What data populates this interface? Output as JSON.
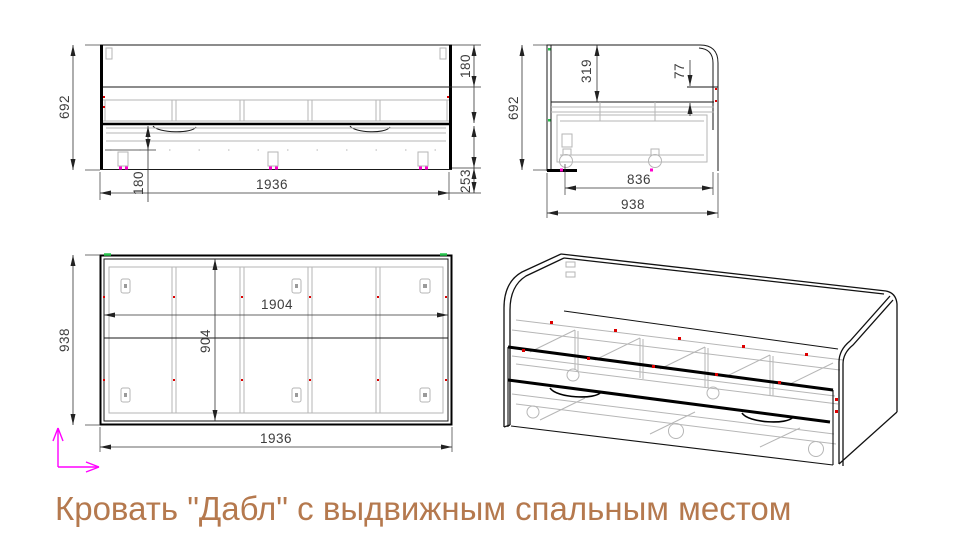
{
  "title": {
    "text": "Кровать \"Дабл\" с выдвижным спальным местом"
  },
  "colors": {
    "title_text": "#b5794e",
    "main_line": "#000000",
    "secondary_line": "#b6b6b6",
    "dimension_text": "#3d3d3d",
    "marker_red": "#dd0000",
    "marker_magenta": "#ff00ff",
    "marker_green": "#00b050"
  },
  "views": {
    "front": {
      "dims": {
        "overall_height": "692",
        "headboard_band": "180",
        "overall_length": "1936",
        "drawer_inset": "180",
        "base_height": "253"
      }
    },
    "side": {
      "dims": {
        "overall_height": "692",
        "top_to_rail": "319",
        "rail_lip": "77",
        "drawer_depth": "836",
        "overall_depth": "938"
      }
    },
    "top": {
      "dims": {
        "overall_depth": "938",
        "inner_length": "1904",
        "inner_width": "904",
        "overall_length": "1936"
      }
    }
  }
}
